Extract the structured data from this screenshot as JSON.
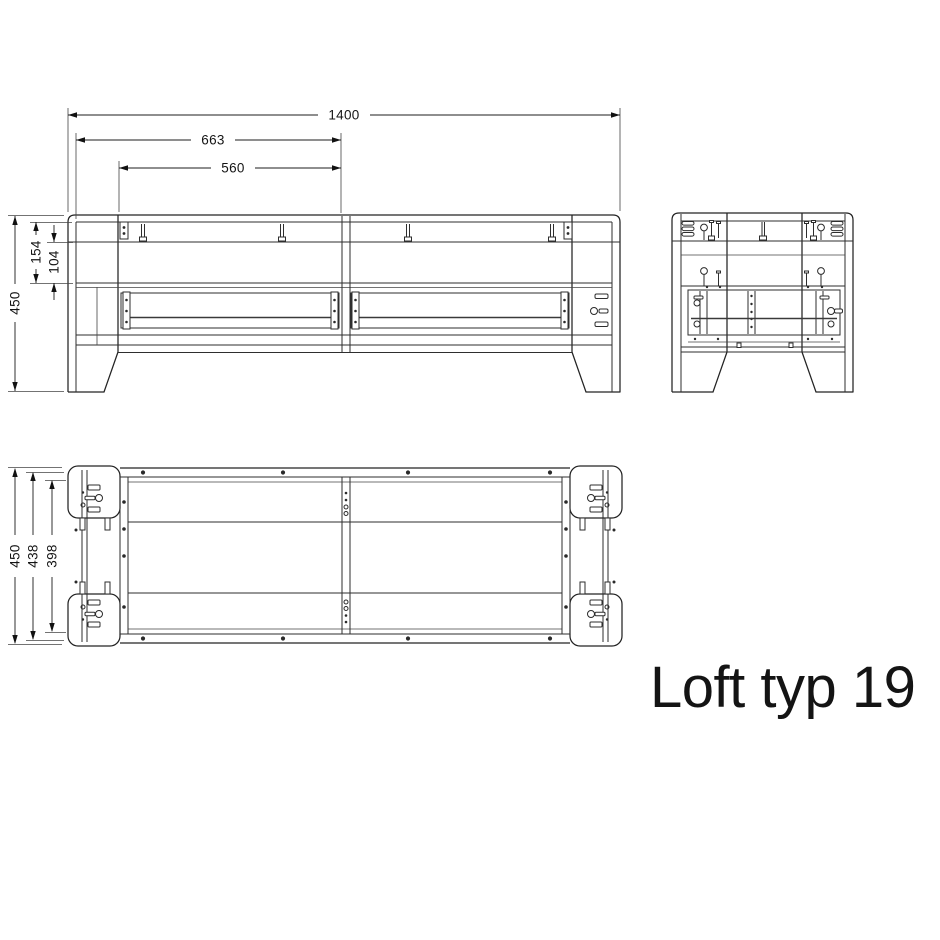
{
  "title": "Loft typ 19",
  "dimensions": {
    "front": {
      "overall_width": "1400",
      "left_section_width": "663",
      "panel_width": "560",
      "overall_height": "450",
      "top_section_height": "154",
      "apron_height": "104"
    },
    "plan": {
      "overall_depth": "450",
      "frame_depth": "438",
      "inner_depth": "398"
    }
  }
}
